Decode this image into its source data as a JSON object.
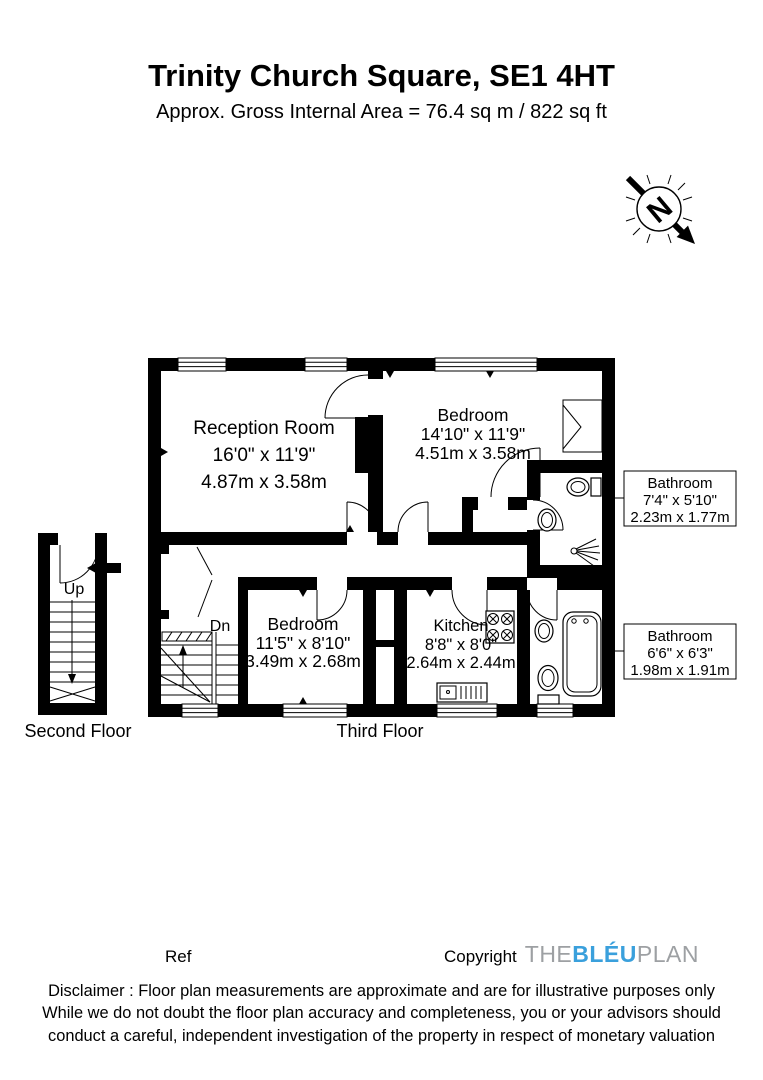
{
  "header": {
    "title": "Trinity Church Square, SE1 4HT",
    "subtitle": "Approx. Gross Internal Area = 76.4 sq m / 822 sq ft"
  },
  "north": {
    "label": "N"
  },
  "floors": {
    "second": "Second Floor",
    "third": "Third Floor"
  },
  "rooms": {
    "reception": {
      "name": "Reception Room",
      "imperial": "16'0\" x 11'9\"",
      "metric": "4.87m x 3.58m"
    },
    "bedroom1": {
      "name": "Bedroom",
      "imperial": "14'10\" x 11'9\"",
      "metric": "4.51m x 3.58m"
    },
    "bedroom2": {
      "name": "Bedroom",
      "imperial": "11'5\" x 8'10\"",
      "metric": "3.49m x 2.68m"
    },
    "kitchen": {
      "name": "Kitchen",
      "imperial": "8'8\" x 8'0\"",
      "metric": "2.64m x 2.44m"
    }
  },
  "callouts": {
    "bathroom1": {
      "name": "Bathroom",
      "imperial": "7'4\" x 5'10\"",
      "metric": "2.23m x 1.77m"
    },
    "bathroom2": {
      "name": "Bathroom",
      "imperial": "6'6\" x 6'3\"",
      "metric": "1.98m x 1.91m"
    }
  },
  "stairs": {
    "up": "Up",
    "down": "Dn"
  },
  "footer": {
    "ref_label": "Ref",
    "copyright_label": "Copyright",
    "logo": {
      "part1": "THE",
      "part2": "BLÉU",
      "part3": "PLAN"
    },
    "disclaimer_line1": "Disclaimer : Floor plan measurements are approximate and are for illustrative purposes only",
    "disclaimer_line2": "While we do not doubt the floor plan accuracy and completeness, you or your advisors should",
    "disclaimer_line3": "conduct a careful, independent investigation of the property in respect of monetary valuation"
  },
  "colors": {
    "ink": "#000000",
    "logo_gray": "#9da0a3",
    "logo_blue": "#3aa0dc"
  }
}
